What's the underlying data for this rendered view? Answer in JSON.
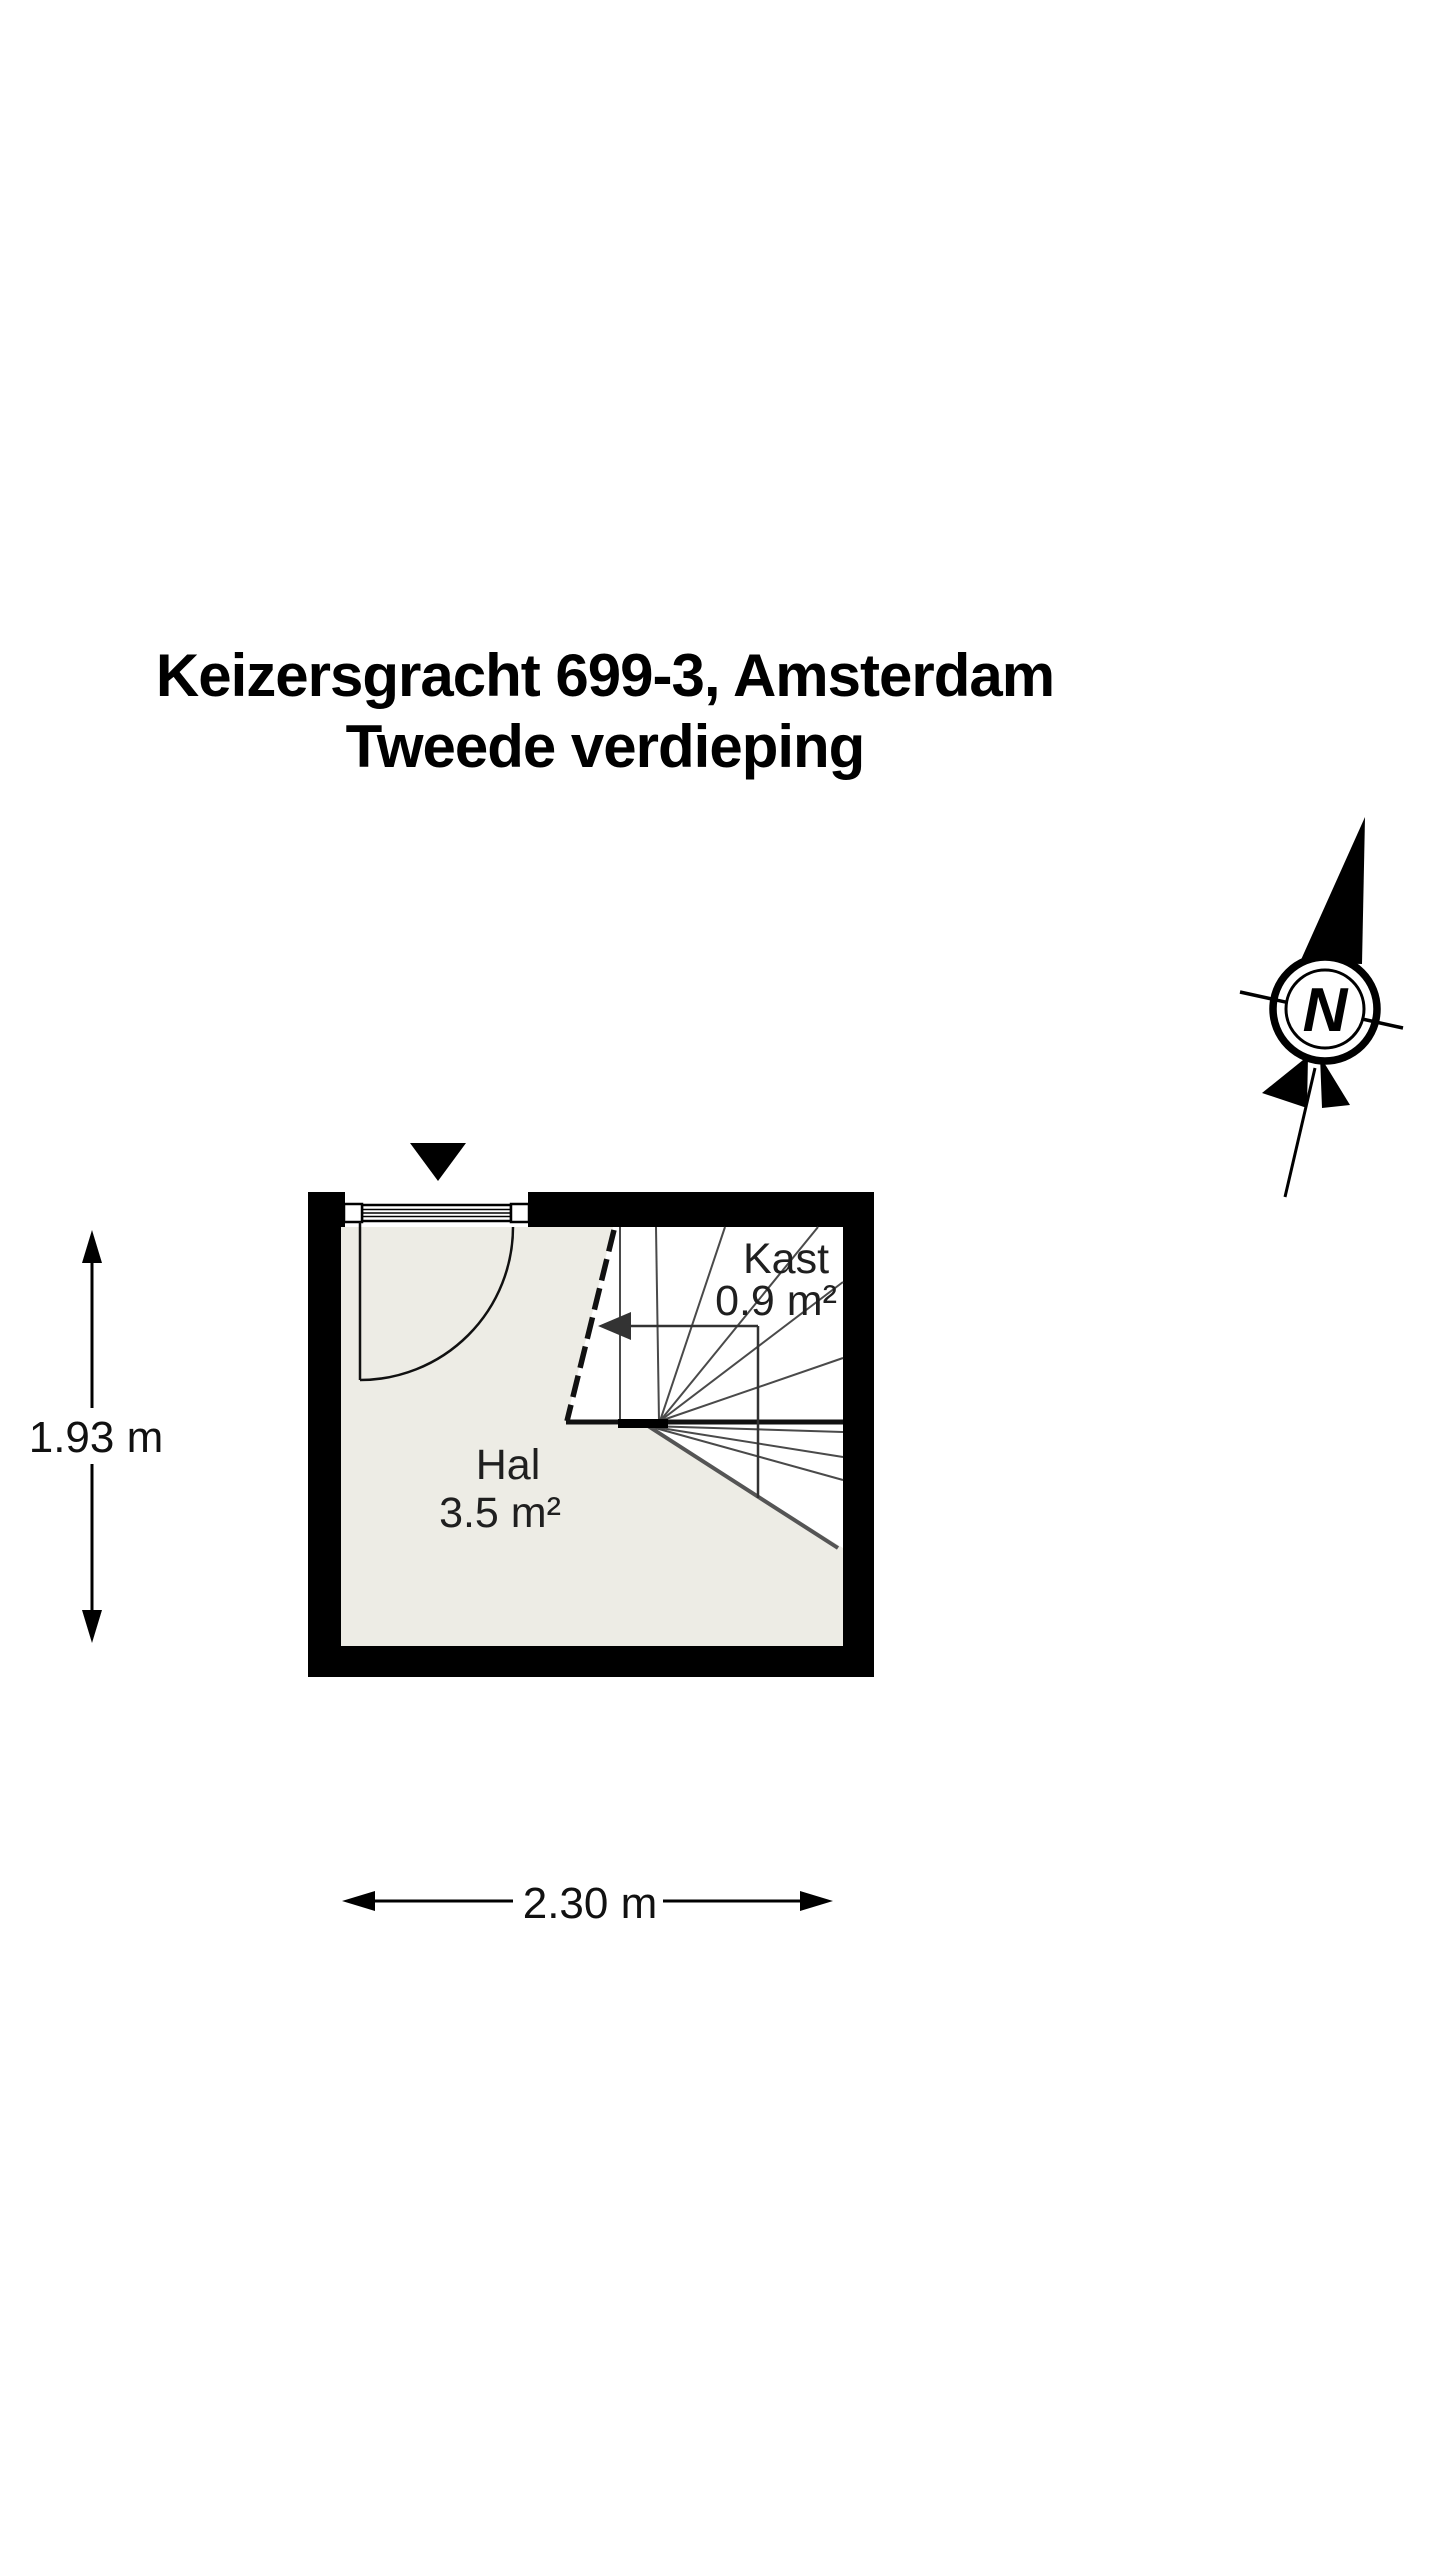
{
  "title": {
    "line1": "Keizersgracht 699-3, Amsterdam",
    "line2": "Tweede verdieping"
  },
  "compass": {
    "label": "N"
  },
  "floorplan": {
    "rooms": {
      "hal": {
        "name": "Hal",
        "area": "3.5 m²"
      },
      "kast": {
        "name": "Kast",
        "area": "0.9 m²"
      }
    },
    "dimensions": {
      "height_label": "1.93 m",
      "width_label": "2.30 m"
    },
    "colors": {
      "wall": "#000000",
      "floor": "#edece5",
      "stair_line": "#4a4a4a",
      "stair_edge": "#555555",
      "walk_line": "#333333",
      "text": "#1f1f1f"
    }
  }
}
